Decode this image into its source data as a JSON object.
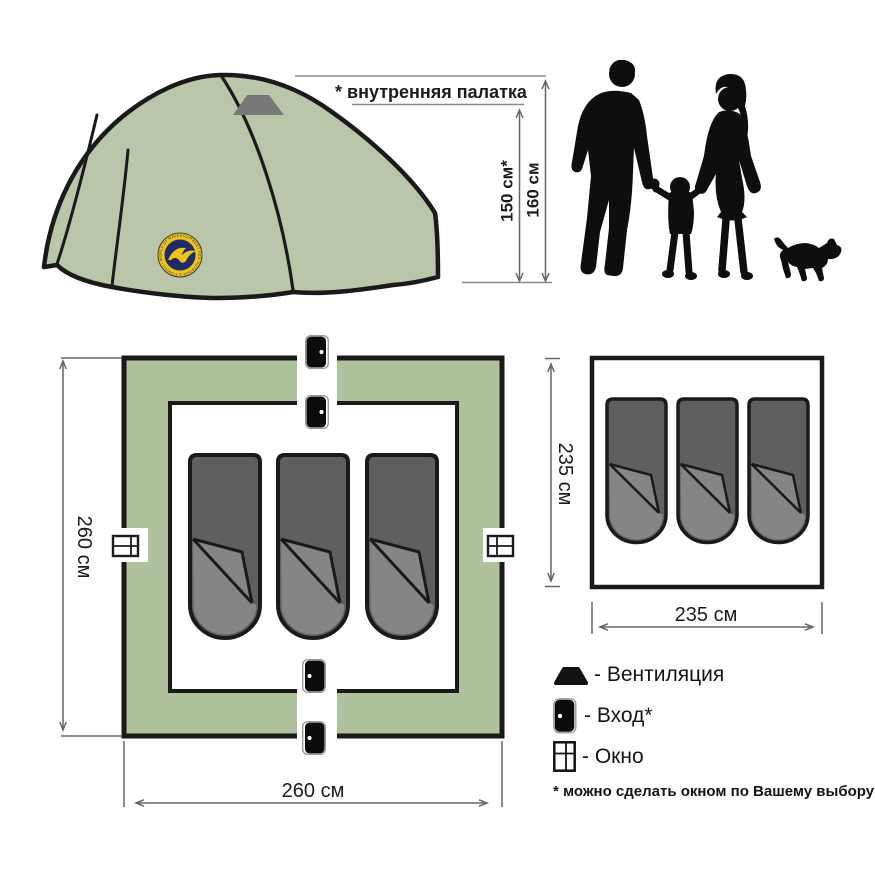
{
  "tent_view": {
    "badge_ring_text": "EQUIPMENT FOR OUTDOOR & FISHING • WORLD OF MAVERICK •"
  },
  "annotations": {
    "inner_tent_note": "* внутренняя палатка",
    "inner_height": "150 см*",
    "outer_height": "160 см"
  },
  "outer_plan": {
    "height_label": "260 см",
    "width_label": "260 см"
  },
  "inner_plan": {
    "height_label": "235 см",
    "width_label": "235 см"
  },
  "legend": {
    "vent_label": "- Вентиляция",
    "entrance_label": "- Вход*",
    "window_label": "- Окно",
    "footnote": "* можно сделать окном по Вашему выбору"
  },
  "colors": {
    "tent_green": "#b9c6a9",
    "plan_green": "#b0c19e",
    "bag_dark": "#5f5f5f",
    "bag_light": "#858585",
    "outline": "#1a1a1a",
    "dim_line": "#666666",
    "vent_gray": "#787878",
    "badge_gold": "#edc41c",
    "badge_navy": "#1f2a66",
    "silhouette": "#0e0e0e"
  }
}
